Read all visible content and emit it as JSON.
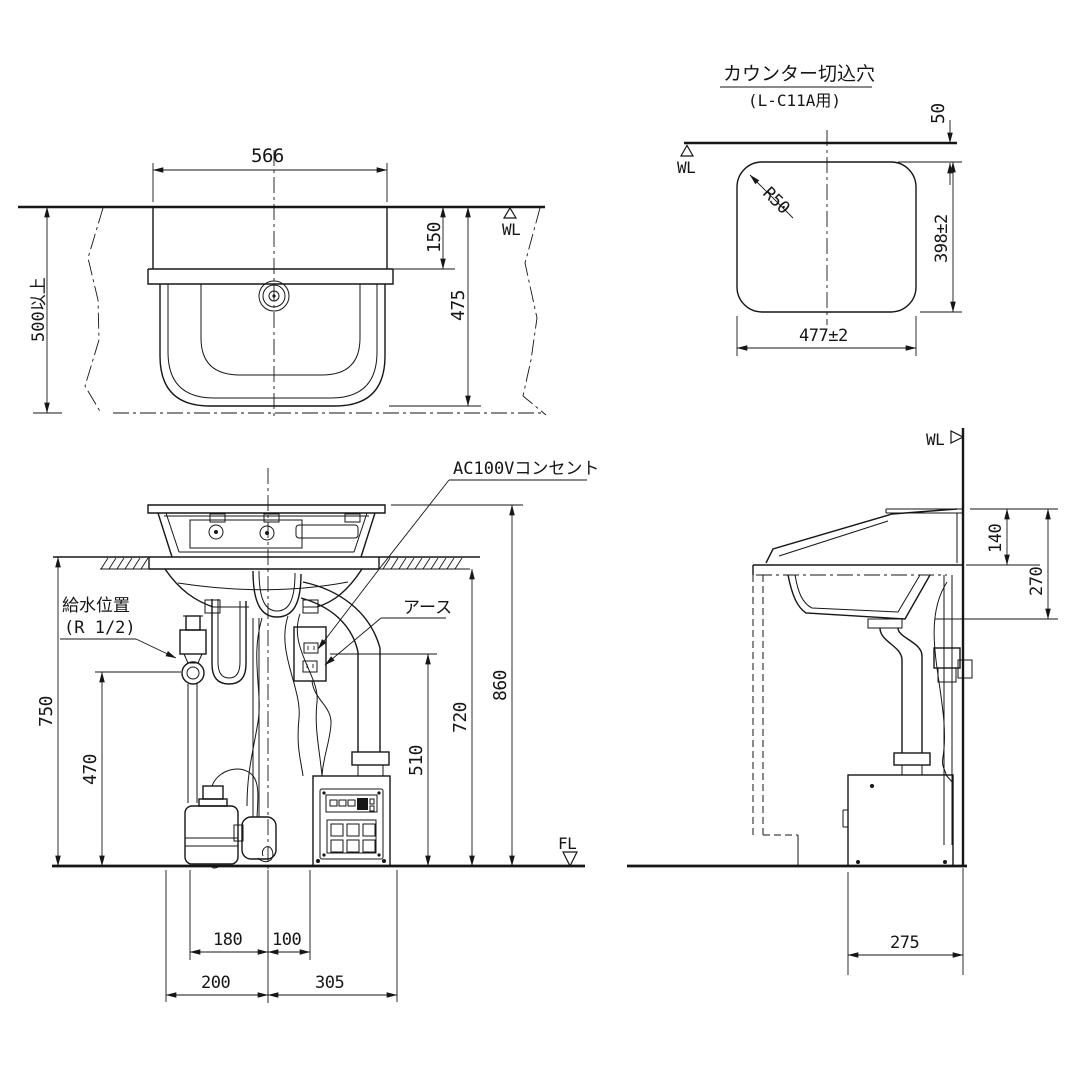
{
  "plan_view": {
    "dim_width": "566",
    "dim_ledge": "150",
    "dim_depth": "475",
    "dim_clearance": "500以上",
    "wl": "WL"
  },
  "cutout_view": {
    "title": "カウンター切込穴",
    "subtitle": "(L-C11A用)",
    "dim_offset": "50",
    "dim_height": "398±2",
    "dim_width": "477±2",
    "dim_radius": "R50",
    "wl": "WL"
  },
  "front_view": {
    "label_outlet": "AC100Vコンセント",
    "label_earth": "アース",
    "label_supply1": "給水位置",
    "label_supply2": "(R 1/2)",
    "dim_750": "750",
    "dim_470": "470",
    "dim_510": "510",
    "dim_720": "720",
    "dim_860": "860",
    "dim_180": "180",
    "dim_100": "100",
    "dim_200": "200",
    "dim_305": "305",
    "fl": "FL"
  },
  "side_view": {
    "dim_140": "140",
    "dim_270": "270",
    "dim_275": "275",
    "wl": "WL"
  }
}
